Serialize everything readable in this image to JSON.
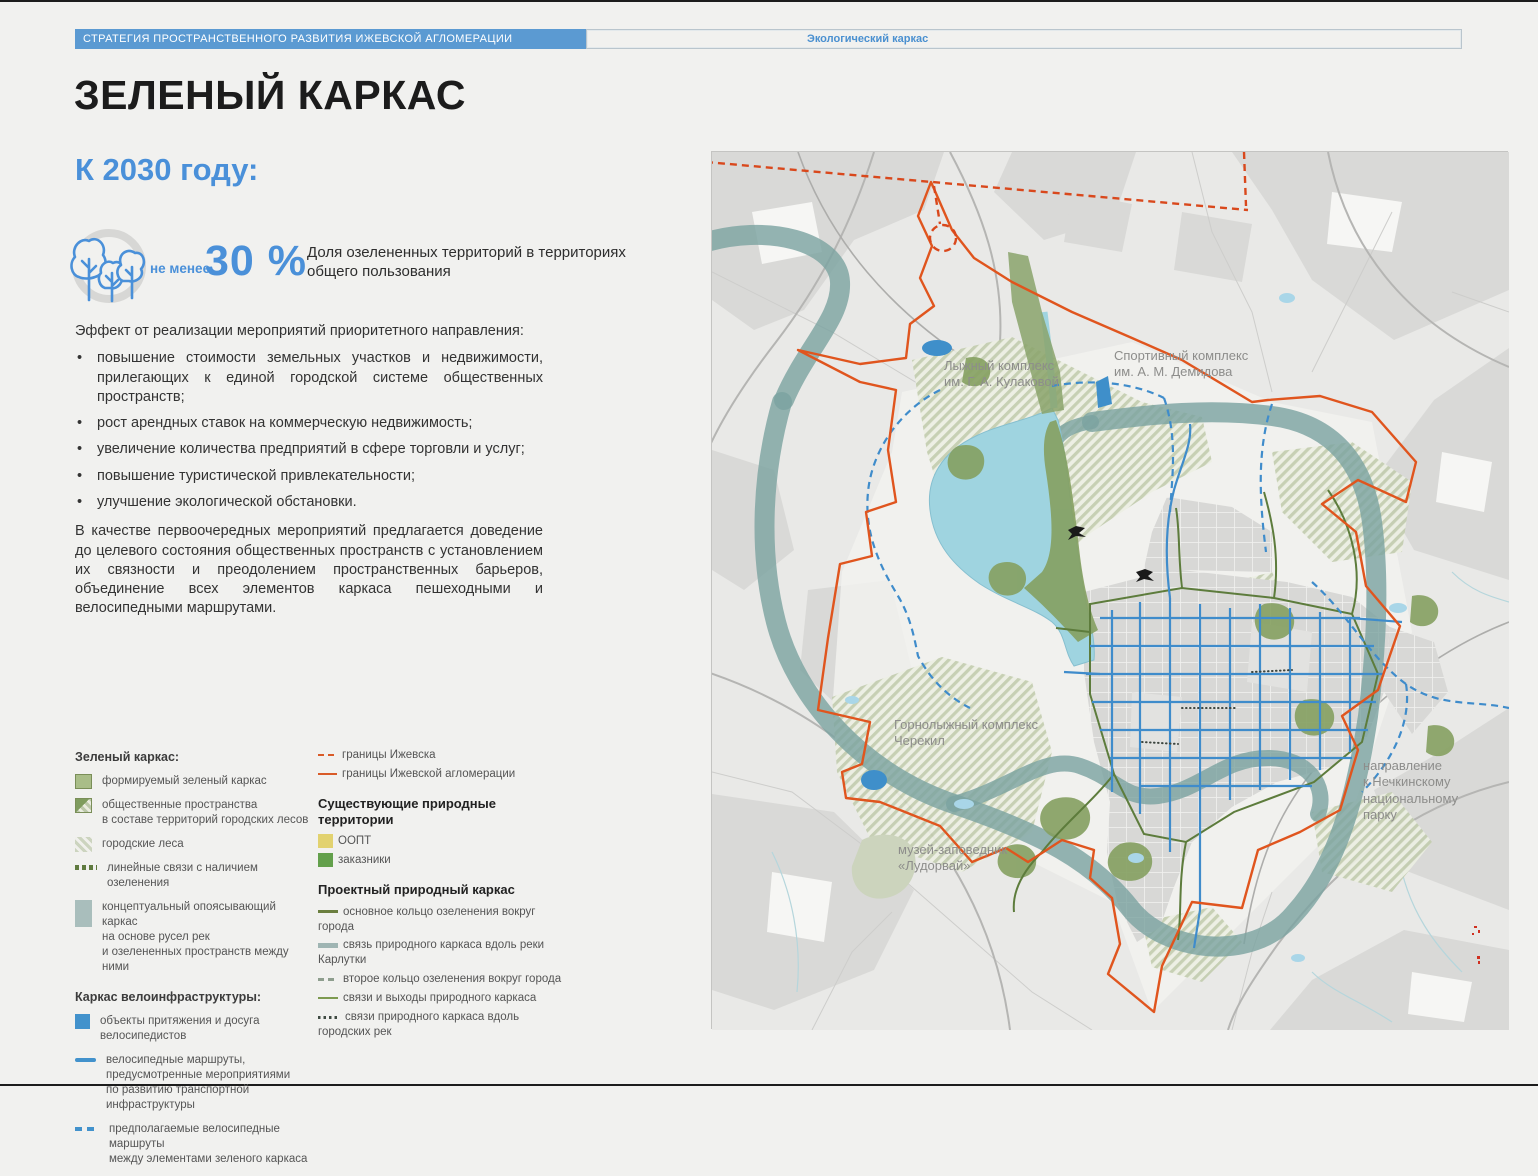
{
  "header": {
    "strategy": "СТРАТЕГИЯ ПРОСТРАНСТВЕННОГО РАЗВИТИЯ ИЖЕВСКОЙ АГЛОМЕРАЦИИ",
    "section": "Экологический каркас"
  },
  "title": "ЗЕЛЕНЫЙ КАРКАС",
  "subtitle": "К 2030 году:",
  "stat": {
    "prefix": "не менее",
    "value": "30 %",
    "description": "Доля озелененных территорий в территориях общего пользования"
  },
  "effects": {
    "intro": "Эффект от реализации мероприятий приоритетного направления:",
    "bullets": [
      "повышение стоимости земельных участков и недвижимости, прилегающих к единой городской системе общественных пространств;",
      "рост арендных ставок на коммерческую недвижимость;",
      "увеличение количества предприятий в сфере торговли и услуг;",
      "повышение туристической привлекательности;",
      "улучшение экологической обстановки."
    ],
    "conclusion": "В качестве первоочередных мероприятий предлагается доведение до целевого состояния общественных пространств с установлением их связности и преодолением пространственных барьеров, объединение всех элементов каркаса пешеходными и велосипедными маршрутами."
  },
  "legend": {
    "green": {
      "heading": "Зеленый каркас:",
      "items": [
        "формируемый зеленый каркас",
        "общественные пространства\nв составе территорий городских лесов",
        "городские леса",
        "линейные связи с наличием озеленения",
        "концептуальный опоясывающий каркас\nна основе русел рек\nи озелененных пространств между ними"
      ]
    },
    "bike": {
      "heading": "Каркас велоинфраструктуры:",
      "items": [
        "объекты притяжения и досуга\nвелосипедистов",
        "велосипедные маршруты,\nпредусмотренные мероприятиями\nпо развитию транспортной\nинфраструктуры",
        "предполагаемые велосипедные маршруты\nмежду элементами зеленого каркаса"
      ]
    },
    "boundaries": {
      "city": "границы Ижевска",
      "agglomeration": "границы Ижевской агломерации"
    },
    "natural": {
      "heading": "Существующие природные территории",
      "oopt": "ООПТ",
      "zakazniki": "заказники"
    },
    "project": {
      "heading": "Проектный природный каркас",
      "items": [
        "основное кольцо озеленения вокруг города",
        "связь природного каркаса вдоль реки Карлутки",
        "второе кольцо озеленения вокруг города",
        "связи и выходы природного каркаса",
        "связи природного каркаса вдоль городских рек"
      ]
    }
  },
  "map": {
    "labels": {
      "ski": "Лыжный комплекс\nим. Г. А. Кулаковой",
      "sport": "Спортивный комплекс\nим. А. М. Демидова",
      "alpine": "Горнолыжный комплекс\nЧерекил",
      "museum": "музей-заповедник\n«Лудорвай»",
      "direction": "направление\nк Нечкинскому\nнациональному\nпарку"
    }
  },
  "colors": {
    "accent_blue": "#4a90d9",
    "header_bar": "#5b9ad2",
    "boundary_orange": "#e0551e",
    "bike_blue": "#3f8ccb",
    "framework_green": "#85a061",
    "pond_water": "#9fd4e0",
    "river_ring": "#7ba2a0",
    "oopt_yellow": "#e2d26f",
    "zakaznik_green": "#63a04b"
  }
}
